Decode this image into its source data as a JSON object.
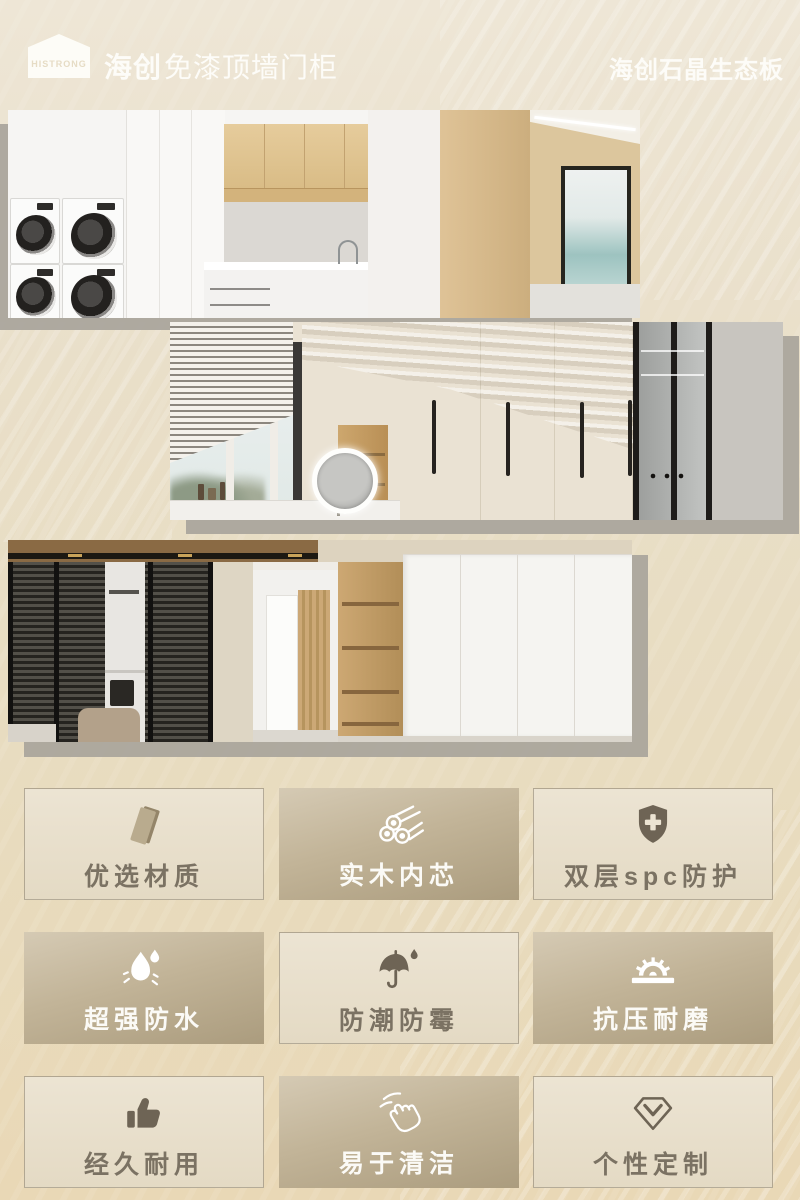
{
  "header": {
    "logo_text": "HISTRONG",
    "brand": "海创",
    "product_line": "免漆顶墙门柜",
    "right_title": "海创石晶生态板"
  },
  "gallery": [
    {
      "name": "laundry-room-with-stacked-washers-and-sea-view-door"
    },
    {
      "name": "dressing-area-wardrobe-with-blinds-and-led-mirror"
    },
    {
      "name": "living-room-glass-partition-hallway-and-white-cabinet"
    }
  ],
  "features": [
    {
      "label": "优选材质",
      "icon": "board-icon",
      "variant": "light"
    },
    {
      "label": "实木内芯",
      "icon": "logs-icon",
      "variant": "dark"
    },
    {
      "label": "双层spc防护",
      "icon": "shield-plus-icon",
      "variant": "light"
    },
    {
      "label": "超强防水",
      "icon": "water-drops-icon",
      "variant": "dark"
    },
    {
      "label": "防潮防霉",
      "icon": "umbrella-drop-icon",
      "variant": "light"
    },
    {
      "label": "抗压耐磨",
      "icon": "saw-blade-icon",
      "variant": "dark"
    },
    {
      "label": "经久耐用",
      "icon": "thumbs-up-icon",
      "variant": "light"
    },
    {
      "label": "易于清洁",
      "icon": "wipe-hand-icon",
      "variant": "dark"
    },
    {
      "label": "个性定制",
      "icon": "diamond-icon",
      "variant": "light"
    }
  ],
  "colors": {
    "background": "#e9dfc9",
    "photo_shadow": "#a8a49b",
    "card_dark_text": "#fbfaf6",
    "card_light_text": "#7b7263",
    "icon_dark": "#6e6455",
    "icon_light": "#ffffff",
    "header_text": "#fdfcf8"
  }
}
